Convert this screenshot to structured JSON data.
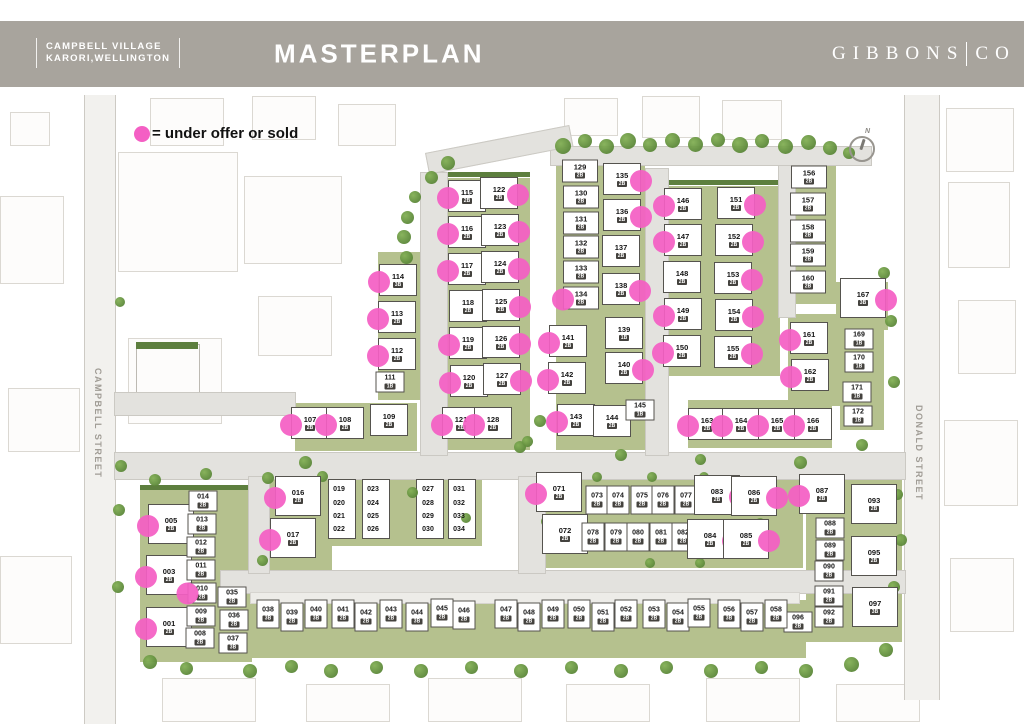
{
  "header": {
    "brand_line1": "CAMPBELL VILLAGE",
    "brand_line2": "KARORI,WELLINGTON",
    "title": "MASTERPLAN",
    "logo_left": "GIBBONS",
    "logo_right": "CO"
  },
  "legend": {
    "text": "= under offer or sold"
  },
  "compass": {
    "label": "N"
  },
  "streets": {
    "left": "CAMPBELL STREET",
    "right": "DONALD STREET"
  },
  "colors": {
    "header_bg": "#a8a49d",
    "sold_dot": "#f45fc4",
    "road": "#e3e2de",
    "green": "#b5c18e",
    "hedge_green": "#5d7f3e",
    "lot_border": "#55534e"
  },
  "defaults": {
    "beds": "2B",
    "type": "m",
    "dot_side": "l",
    "sold": false
  },
  "lots": [
    {
      "n": "114",
      "x": 398,
      "y": 280,
      "s": 1,
      "b": "3B"
    },
    {
      "n": "113",
      "x": 397,
      "y": 317,
      "s": 1
    },
    {
      "n": "112",
      "x": 397,
      "y": 354,
      "s": 1
    },
    {
      "n": "111",
      "x": 390,
      "y": 382,
      "t": "s",
      "b": "1B"
    },
    {
      "n": "107",
      "x": 310,
      "y": 423,
      "s": 1
    },
    {
      "n": "108",
      "x": 345,
      "y": 423,
      "s": 1
    },
    {
      "n": "109",
      "x": 389,
      "y": 420
    },
    {
      "n": "115",
      "x": 467,
      "y": 196,
      "s": 1
    },
    {
      "n": "116",
      "x": 467,
      "y": 232,
      "s": 1
    },
    {
      "n": "117",
      "x": 467,
      "y": 269,
      "s": 1
    },
    {
      "n": "118",
      "x": 468,
      "y": 306
    },
    {
      "n": "119",
      "x": 468,
      "y": 343,
      "s": 1
    },
    {
      "n": "120",
      "x": 469,
      "y": 381,
      "s": 1
    },
    {
      "n": "121",
      "x": 461,
      "y": 423,
      "s": 1
    },
    {
      "n": "122",
      "x": 499,
      "y": 193,
      "s": 1,
      "d": "r"
    },
    {
      "n": "123",
      "x": 500,
      "y": 230,
      "s": 1,
      "d": "r"
    },
    {
      "n": "124",
      "x": 500,
      "y": 267,
      "s": 1,
      "d": "r"
    },
    {
      "n": "125",
      "x": 501,
      "y": 305,
      "s": 1,
      "d": "r"
    },
    {
      "n": "126",
      "x": 501,
      "y": 342,
      "s": 1,
      "d": "r"
    },
    {
      "n": "127",
      "x": 502,
      "y": 379,
      "s": 1,
      "d": "r"
    },
    {
      "n": "128",
      "x": 493,
      "y": 423,
      "s": 1
    },
    {
      "n": "129",
      "x": 580,
      "y": 171,
      "t": "n"
    },
    {
      "n": "130",
      "x": 581,
      "y": 197,
      "t": "n"
    },
    {
      "n": "131",
      "x": 581,
      "y": 223,
      "t": "n"
    },
    {
      "n": "132",
      "x": 581,
      "y": 247,
      "t": "n"
    },
    {
      "n": "133",
      "x": 581,
      "y": 272,
      "t": "n"
    },
    {
      "n": "134",
      "x": 581,
      "y": 298,
      "t": "n",
      "s": 1
    },
    {
      "n": "135",
      "x": 622,
      "y": 179,
      "s": 1,
      "d": "r"
    },
    {
      "n": "136",
      "x": 622,
      "y": 215,
      "s": 1,
      "d": "r"
    },
    {
      "n": "137",
      "x": 621,
      "y": 251
    },
    {
      "n": "138",
      "x": 621,
      "y": 289,
      "s": 1,
      "d": "r"
    },
    {
      "n": "139",
      "x": 624,
      "y": 333,
      "b": "1B"
    },
    {
      "n": "140",
      "x": 624,
      "y": 368,
      "s": 1,
      "d": "r"
    },
    {
      "n": "141",
      "x": 568,
      "y": 341,
      "s": 1
    },
    {
      "n": "142",
      "x": 567,
      "y": 378,
      "s": 1
    },
    {
      "n": "143",
      "x": 576,
      "y": 420,
      "s": 1
    },
    {
      "n": "144",
      "x": 612,
      "y": 421
    },
    {
      "n": "145",
      "x": 640,
      "y": 410,
      "t": "s",
      "b": "1B"
    },
    {
      "n": "146",
      "x": 683,
      "y": 204,
      "s": 1
    },
    {
      "n": "147",
      "x": 683,
      "y": 240,
      "s": 1
    },
    {
      "n": "148",
      "x": 682,
      "y": 277
    },
    {
      "n": "149",
      "x": 683,
      "y": 314,
      "s": 1
    },
    {
      "n": "150",
      "x": 682,
      "y": 351,
      "s": 1
    },
    {
      "n": "151",
      "x": 736,
      "y": 203,
      "s": 1,
      "d": "r"
    },
    {
      "n": "152",
      "x": 734,
      "y": 240,
      "s": 1,
      "d": "r"
    },
    {
      "n": "153",
      "x": 733,
      "y": 278,
      "s": 1,
      "d": "r"
    },
    {
      "n": "154",
      "x": 734,
      "y": 315,
      "s": 1,
      "d": "r"
    },
    {
      "n": "155",
      "x": 733,
      "y": 352,
      "s": 1,
      "d": "r"
    },
    {
      "n": "156",
      "x": 809,
      "y": 177,
      "t": "n"
    },
    {
      "n": "157",
      "x": 808,
      "y": 204,
      "t": "n"
    },
    {
      "n": "158",
      "x": 808,
      "y": 231,
      "t": "n"
    },
    {
      "n": "159",
      "x": 808,
      "y": 255,
      "t": "n"
    },
    {
      "n": "160",
      "x": 808,
      "y": 282,
      "t": "n"
    },
    {
      "n": "167",
      "x": 863,
      "y": 298,
      "t": "b",
      "s": 1,
      "d": "r",
      "b": "3B"
    },
    {
      "n": "161",
      "x": 809,
      "y": 338,
      "s": 1
    },
    {
      "n": "162",
      "x": 810,
      "y": 375,
      "s": 1
    },
    {
      "n": "169",
      "x": 859,
      "y": 339,
      "t": "s",
      "b": "1B"
    },
    {
      "n": "170",
      "x": 859,
      "y": 362,
      "t": "s",
      "b": "1B"
    },
    {
      "n": "171",
      "x": 857,
      "y": 392,
      "t": "s",
      "b": "1B"
    },
    {
      "n": "172",
      "x": 858,
      "y": 416,
      "t": "s",
      "b": "1B"
    },
    {
      "n": "163",
      "x": 707,
      "y": 424,
      "s": 1
    },
    {
      "n": "164",
      "x": 741,
      "y": 424,
      "s": 1
    },
    {
      "n": "165",
      "x": 777,
      "y": 424,
      "s": 1
    },
    {
      "n": "166",
      "x": 813,
      "y": 424,
      "s": 1
    },
    {
      "n": "005",
      "x": 171,
      "y": 524,
      "t": "b",
      "s": 1
    },
    {
      "n": "003",
      "x": 169,
      "y": 575,
      "t": "b",
      "s": 1
    },
    {
      "n": "001",
      "x": 169,
      "y": 627,
      "t": "b",
      "s": 1
    },
    {
      "n": "014",
      "x": 203,
      "y": 501,
      "t": "s"
    },
    {
      "n": "013",
      "x": 202,
      "y": 524,
      "t": "s"
    },
    {
      "n": "012",
      "x": 201,
      "y": 547,
      "t": "s"
    },
    {
      "n": "011",
      "x": 201,
      "y": 570,
      "t": "s"
    },
    {
      "n": "010",
      "x": 202,
      "y": 593,
      "t": "s",
      "s": 1
    },
    {
      "n": "009",
      "x": 201,
      "y": 616,
      "t": "s"
    },
    {
      "n": "008",
      "x": 200,
      "y": 638,
      "t": "s"
    },
    {
      "n": "035",
      "x": 232,
      "y": 597,
      "t": "s"
    },
    {
      "n": "036",
      "x": 234,
      "y": 620,
      "t": "s"
    },
    {
      "n": "037",
      "x": 233,
      "y": 643,
      "t": "s",
      "b": "3B"
    },
    {
      "n": "016",
      "x": 298,
      "y": 496,
      "t": "b",
      "s": 1
    },
    {
      "n": "017",
      "x": 293,
      "y": 538,
      "t": "b",
      "s": 1
    },
    {
      "n": "019",
      "x": 339,
      "y": 490,
      "t": "r"
    },
    {
      "n": "020",
      "x": 339,
      "y": 504,
      "t": "r"
    },
    {
      "n": "021",
      "x": 339,
      "y": 517,
      "t": "r"
    },
    {
      "n": "022",
      "x": 339,
      "y": 530,
      "t": "r"
    },
    {
      "n": "023",
      "x": 373,
      "y": 490,
      "t": "r"
    },
    {
      "n": "024",
      "x": 373,
      "y": 504,
      "t": "r"
    },
    {
      "n": "025",
      "x": 373,
      "y": 517,
      "t": "r"
    },
    {
      "n": "026",
      "x": 373,
      "y": 530,
      "t": "r"
    },
    {
      "n": "027",
      "x": 428,
      "y": 490,
      "t": "r"
    },
    {
      "n": "028",
      "x": 428,
      "y": 504,
      "t": "r"
    },
    {
      "n": "029",
      "x": 428,
      "y": 517,
      "t": "r"
    },
    {
      "n": "030",
      "x": 428,
      "y": 530,
      "t": "r"
    },
    {
      "n": "031",
      "x": 459,
      "y": 490,
      "t": "r"
    },
    {
      "n": "032",
      "x": 459,
      "y": 504,
      "t": "r"
    },
    {
      "n": "033",
      "x": 459,
      "y": 517,
      "t": "r"
    },
    {
      "n": "034",
      "x": 459,
      "y": 530,
      "t": "r"
    },
    {
      "n": "071",
      "x": 559,
      "y": 492,
      "t": "b",
      "s": 1
    },
    {
      "n": "072",
      "x": 565,
      "y": 534,
      "t": "b"
    },
    {
      "n": "073",
      "x": 597,
      "y": 500,
      "t": "t"
    },
    {
      "n": "074",
      "x": 618,
      "y": 500,
      "t": "t"
    },
    {
      "n": "075",
      "x": 642,
      "y": 500,
      "t": "t"
    },
    {
      "n": "076",
      "x": 663,
      "y": 500,
      "t": "t"
    },
    {
      "n": "077",
      "x": 686,
      "y": 500,
      "t": "t"
    },
    {
      "n": "078",
      "x": 593,
      "y": 537,
      "t": "t"
    },
    {
      "n": "079",
      "x": 616,
      "y": 537,
      "t": "t"
    },
    {
      "n": "080",
      "x": 638,
      "y": 537,
      "t": "t"
    },
    {
      "n": "081",
      "x": 661,
      "y": 537,
      "t": "t"
    },
    {
      "n": "082",
      "x": 683,
      "y": 537,
      "t": "t"
    },
    {
      "n": "083",
      "x": 717,
      "y": 495,
      "t": "b",
      "s": 1,
      "d": "r"
    },
    {
      "n": "086",
      "x": 754,
      "y": 496,
      "t": "b",
      "s": 1,
      "d": "r"
    },
    {
      "n": "084",
      "x": 710,
      "y": 539,
      "t": "b",
      "s": 1,
      "d": "r"
    },
    {
      "n": "085",
      "x": 746,
      "y": 539,
      "t": "b",
      "s": 1,
      "d": "r"
    },
    {
      "n": "087",
      "x": 822,
      "y": 494,
      "t": "b",
      "s": 1
    },
    {
      "n": "093",
      "x": 874,
      "y": 504,
      "t": "b"
    },
    {
      "n": "088",
      "x": 830,
      "y": 528,
      "t": "s"
    },
    {
      "n": "089",
      "x": 830,
      "y": 550,
      "t": "s"
    },
    {
      "n": "090",
      "x": 829,
      "y": 571,
      "t": "s"
    },
    {
      "n": "091",
      "x": 829,
      "y": 596,
      "t": "s"
    },
    {
      "n": "092",
      "x": 829,
      "y": 617,
      "t": "s"
    },
    {
      "n": "095",
      "x": 874,
      "y": 556,
      "t": "b"
    },
    {
      "n": "097",
      "x": 875,
      "y": 607,
      "t": "b",
      "b": "3B"
    },
    {
      "n": "096",
      "x": 798,
      "y": 622,
      "t": "s"
    },
    {
      "n": "038",
      "x": 268,
      "y": 614,
      "t": "t",
      "b": "3B"
    },
    {
      "n": "039",
      "x": 292,
      "y": 617,
      "t": "t"
    },
    {
      "n": "040",
      "x": 316,
      "y": 614,
      "t": "t",
      "b": "3B"
    },
    {
      "n": "041",
      "x": 343,
      "y": 614,
      "t": "t"
    },
    {
      "n": "042",
      "x": 366,
      "y": 617,
      "t": "t"
    },
    {
      "n": "043",
      "x": 391,
      "y": 614,
      "t": "t"
    },
    {
      "n": "044",
      "x": 417,
      "y": 617,
      "t": "t",
      "b": "3B"
    },
    {
      "n": "045",
      "x": 442,
      "y": 613,
      "t": "t"
    },
    {
      "n": "046",
      "x": 464,
      "y": 615,
      "t": "t"
    },
    {
      "n": "047",
      "x": 506,
      "y": 614,
      "t": "t"
    },
    {
      "n": "048",
      "x": 529,
      "y": 617,
      "t": "t"
    },
    {
      "n": "049",
      "x": 553,
      "y": 614,
      "t": "t"
    },
    {
      "n": "050",
      "x": 579,
      "y": 614,
      "t": "t"
    },
    {
      "n": "051",
      "x": 603,
      "y": 617,
      "t": "t"
    },
    {
      "n": "052",
      "x": 626,
      "y": 614,
      "t": "t"
    },
    {
      "n": "053",
      "x": 654,
      "y": 614,
      "t": "t"
    },
    {
      "n": "054",
      "x": 678,
      "y": 617,
      "t": "t"
    },
    {
      "n": "055",
      "x": 699,
      "y": 613,
      "t": "t"
    },
    {
      "n": "056",
      "x": 729,
      "y": 614,
      "t": "t",
      "b": "3B"
    },
    {
      "n": "057",
      "x": 752,
      "y": 617,
      "t": "t"
    },
    {
      "n": "058",
      "x": 776,
      "y": 614,
      "t": "t"
    }
  ],
  "decor": {
    "trees": [
      [
        563,
        146,
        16
      ],
      [
        585,
        141,
        14
      ],
      [
        606,
        146,
        15
      ],
      [
        628,
        141,
        16
      ],
      [
        650,
        145,
        14
      ],
      [
        672,
        140,
        15
      ],
      [
        695,
        144,
        15
      ],
      [
        718,
        140,
        14
      ],
      [
        740,
        145,
        16
      ],
      [
        762,
        141,
        14
      ],
      [
        785,
        146,
        15
      ],
      [
        808,
        142,
        15
      ],
      [
        830,
        148,
        14
      ],
      [
        849,
        153,
        12
      ],
      [
        448,
        163,
        14
      ],
      [
        431,
        177,
        13
      ],
      [
        415,
        197,
        12
      ],
      [
        407,
        217,
        13
      ],
      [
        404,
        237,
        14
      ],
      [
        406,
        257,
        13
      ],
      [
        409,
        277,
        12
      ],
      [
        305,
        462,
        13
      ],
      [
        520,
        447,
        12
      ],
      [
        621,
        455,
        12
      ],
      [
        700,
        459,
        11
      ],
      [
        800,
        462,
        13
      ],
      [
        862,
        445,
        12
      ],
      [
        121,
        466,
        12
      ],
      [
        155,
        480,
        12
      ],
      [
        206,
        474,
        12
      ],
      [
        120,
        302,
        10
      ],
      [
        119,
        510,
        12
      ],
      [
        118,
        587,
        12
      ],
      [
        150,
        662,
        14
      ],
      [
        186,
        668,
        13
      ],
      [
        250,
        671,
        14
      ],
      [
        291,
        666,
        13
      ],
      [
        331,
        671,
        14
      ],
      [
        376,
        667,
        13
      ],
      [
        421,
        671,
        14
      ],
      [
        471,
        667,
        13
      ],
      [
        521,
        671,
        14
      ],
      [
        571,
        667,
        13
      ],
      [
        621,
        671,
        14
      ],
      [
        666,
        667,
        13
      ],
      [
        711,
        671,
        14
      ],
      [
        761,
        667,
        13
      ],
      [
        806,
        671,
        14
      ],
      [
        851,
        664,
        15
      ],
      [
        886,
        650,
        14
      ],
      [
        884,
        273,
        12
      ],
      [
        891,
        321,
        12
      ],
      [
        894,
        382,
        12
      ],
      [
        897,
        494,
        11
      ],
      [
        901,
        540,
        12
      ],
      [
        894,
        587,
        12
      ],
      [
        540,
        421,
        12
      ],
      [
        527,
        441,
        11
      ],
      [
        696,
        416,
        11
      ],
      [
        268,
        478,
        12
      ],
      [
        322,
        476,
        11
      ],
      [
        262,
        560,
        11
      ],
      [
        412,
        492,
        11
      ],
      [
        466,
        518,
        10
      ],
      [
        546,
        521,
        11
      ],
      [
        597,
        477,
        10
      ],
      [
        652,
        477,
        10
      ],
      [
        704,
        477,
        10
      ],
      [
        760,
        523,
        10
      ],
      [
        650,
        563,
        10
      ],
      [
        700,
        563,
        10
      ]
    ]
  }
}
